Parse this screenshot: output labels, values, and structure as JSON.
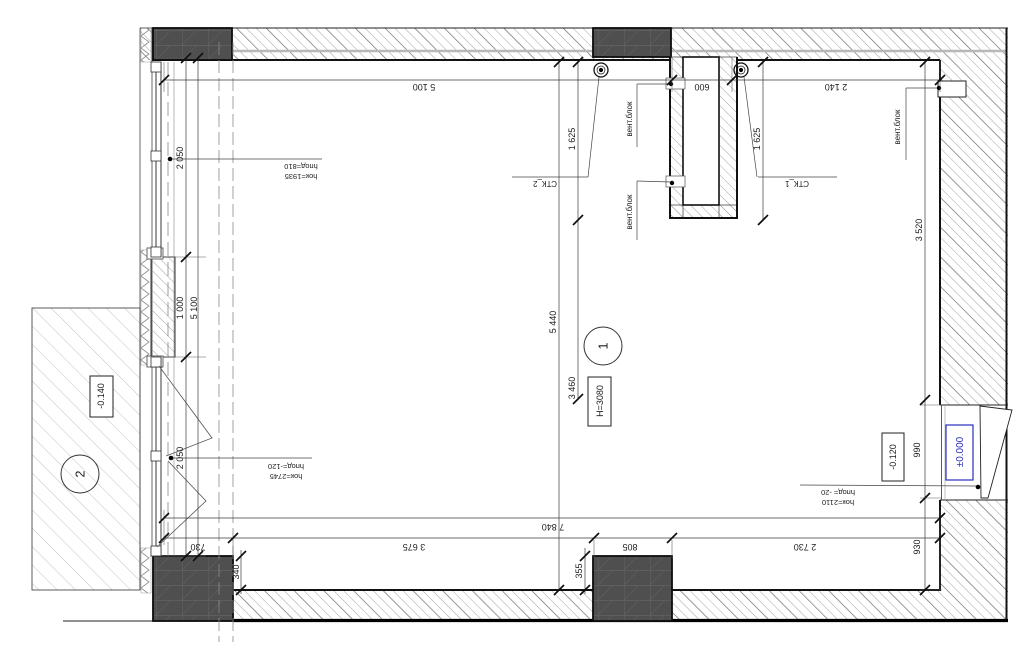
{
  "drawing_title": "floor-plan-fragment",
  "colors": {
    "accent_blue": "#2a2ebd",
    "wall_dark": "#4f4f4f"
  },
  "rooms": {
    "room1": {
      "number": "1",
      "height_label": "H=3080"
    },
    "room2": {
      "number": "2"
    }
  },
  "levels": {
    "terrace": "-0.140",
    "inner": "-0.120",
    "zero": "±0.000"
  },
  "dims": {
    "top": {
      "d1": "5 100",
      "d2": "600",
      "d3": "2 140"
    },
    "bottom": {
      "total": "7 840",
      "d1": "730",
      "d2": "3 675",
      "d3": "805",
      "d4": "2 730"
    },
    "left": {
      "d1": "2 050",
      "d2": "1 000",
      "d3": "2 050",
      "total": "5 100"
    },
    "center": {
      "d1": "5 440",
      "d2": "3 460"
    },
    "right": {
      "d1": "3 520",
      "d2": "990",
      "d3": "930"
    },
    "shaft": {
      "d1": "1 625",
      "d2": "1 625"
    },
    "columns": {
      "d1": "340",
      "d2": "355"
    }
  },
  "labels": {
    "vent_block": "вент.блок",
    "stk1": "СТК_1",
    "stk2": "СТК_2",
    "win1": {
      "h_ok": "hок=1935",
      "h_pod": "hпод=810"
    },
    "win2": {
      "h_ok": "hок=2745",
      "h_pod": "hпод=-120"
    },
    "door": {
      "h_ok": "hок=2110",
      "h_pod": "hпод= -20"
    }
  }
}
